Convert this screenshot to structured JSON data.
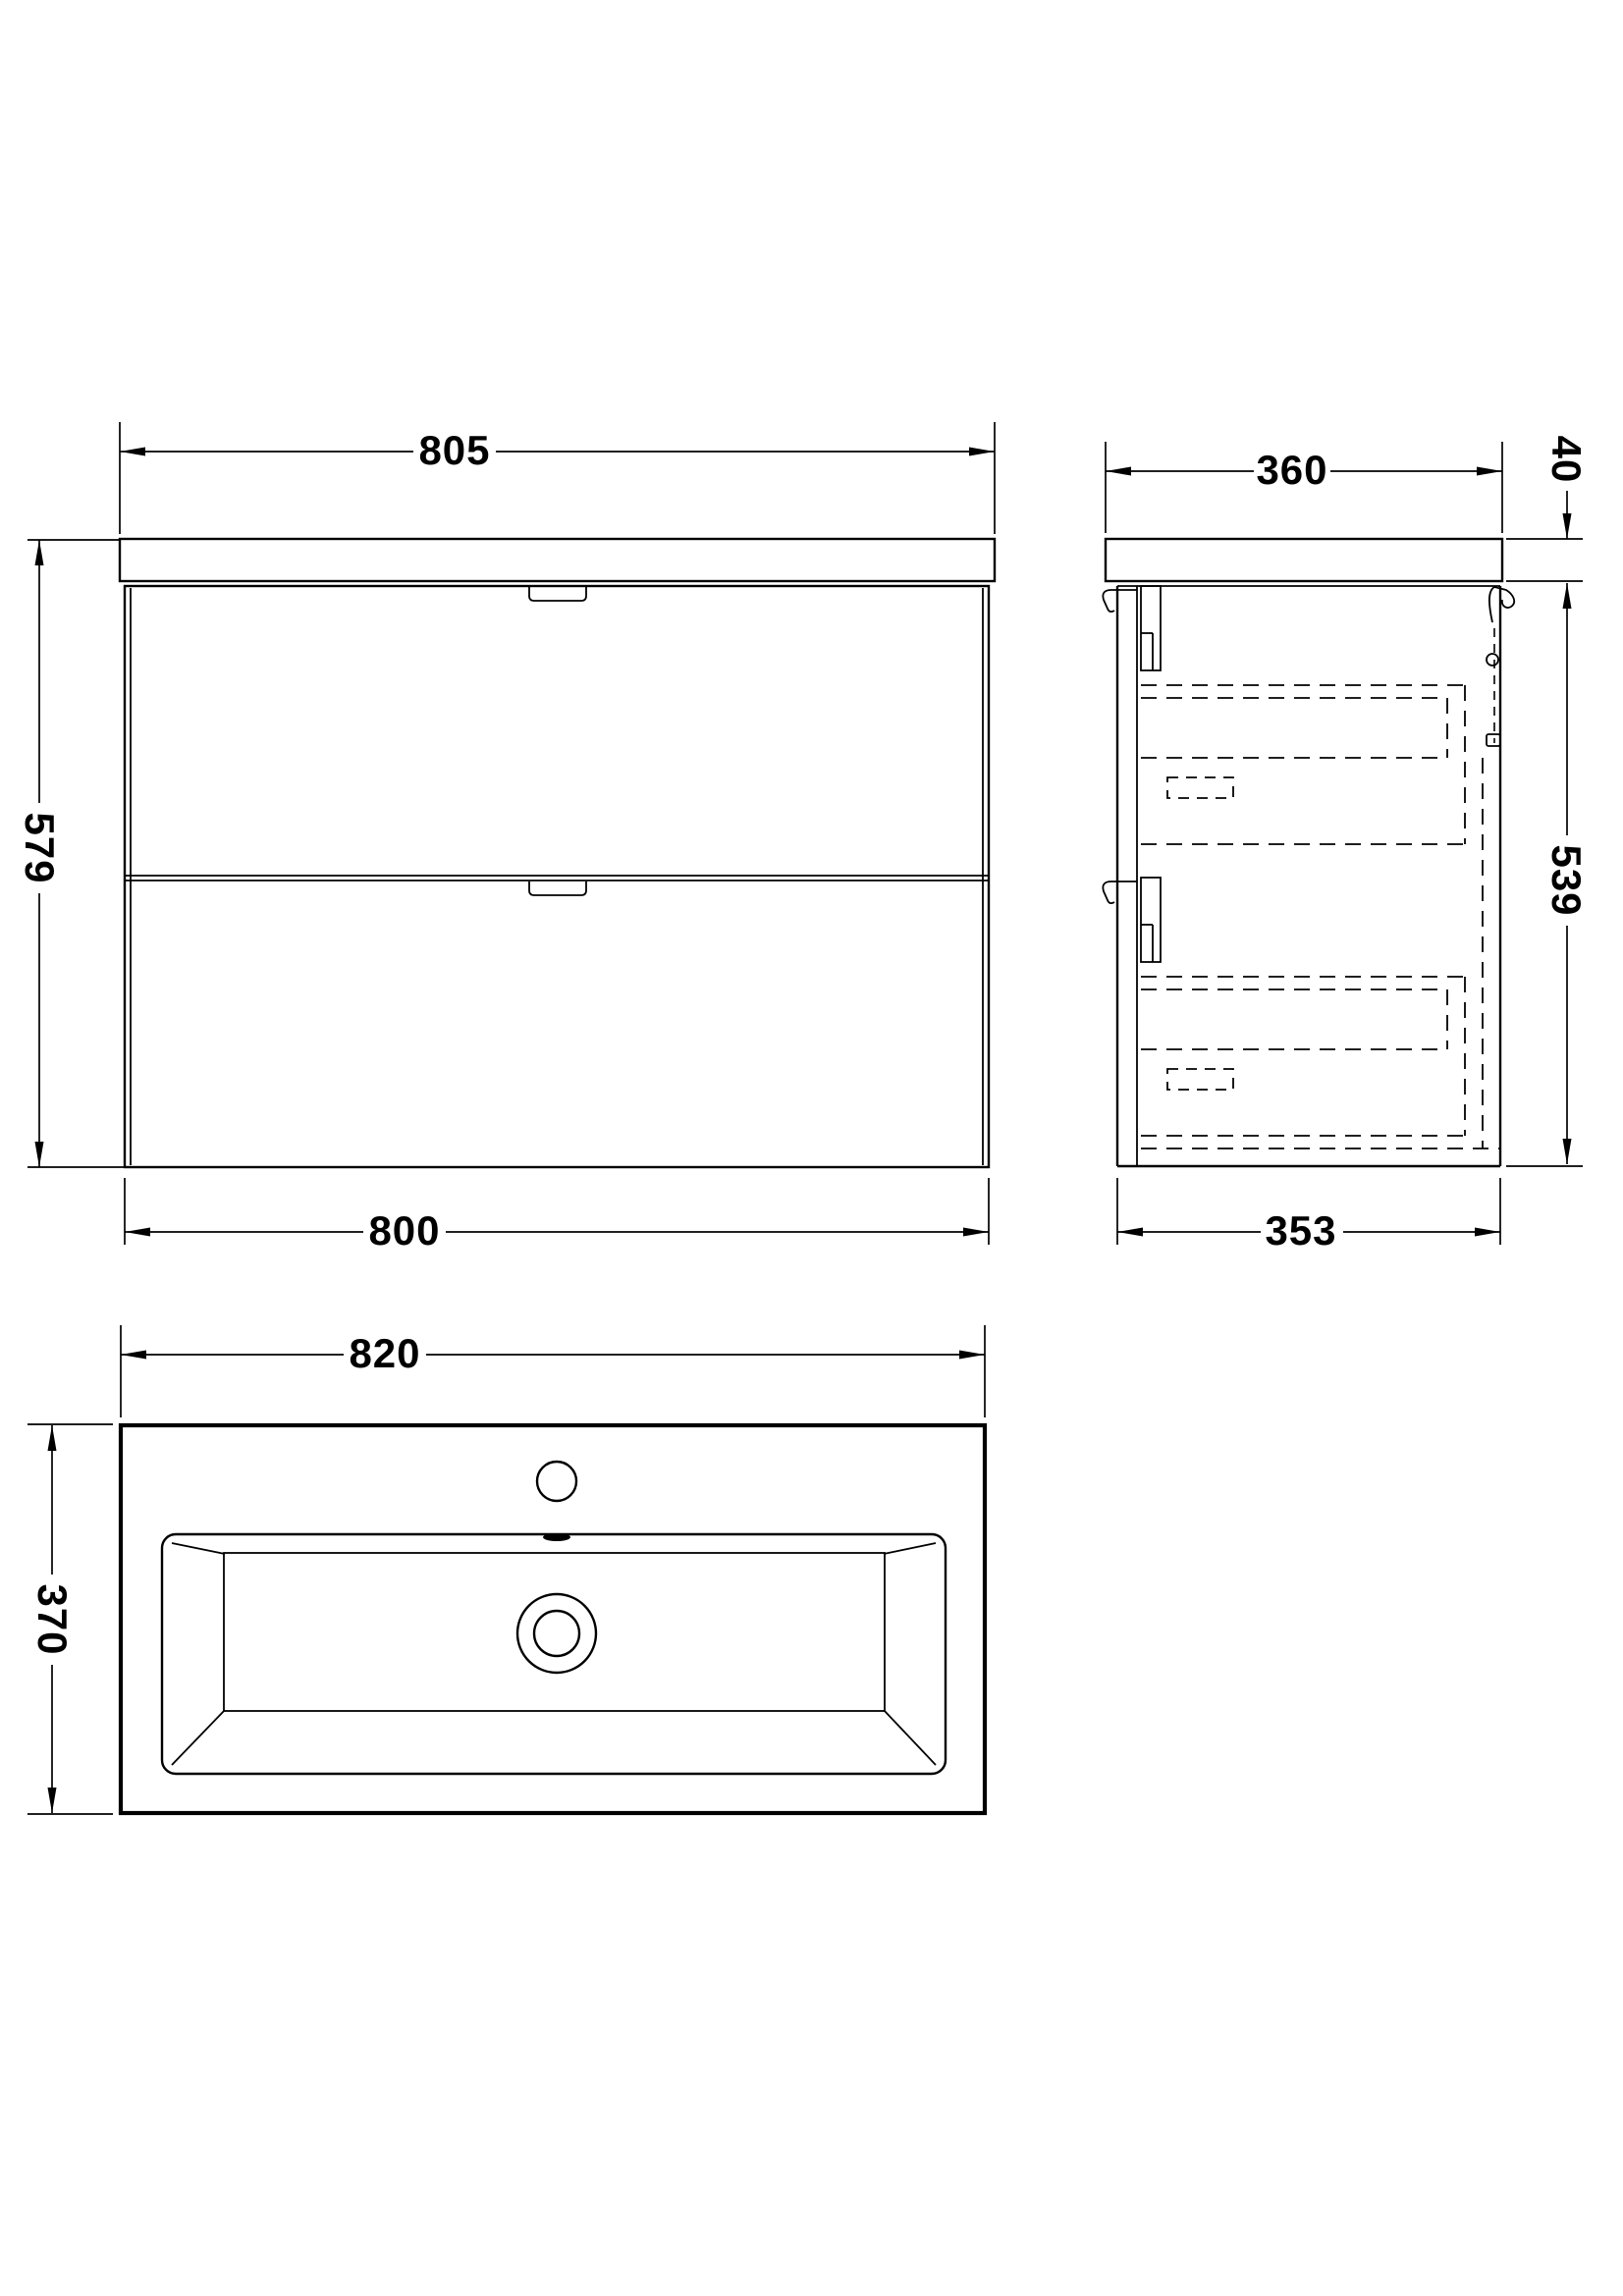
{
  "front_view": {
    "width_top": "805",
    "height_left": "579",
    "width_bottom": "800"
  },
  "side_view": {
    "depth_top": "360",
    "worktop_thickness": "40",
    "cabinet_height": "539",
    "depth_bottom": "353"
  },
  "plan_view": {
    "basin_width": "820",
    "basin_depth": "370"
  },
  "colors": {
    "line": "#000000",
    "background": "#ffffff"
  }
}
